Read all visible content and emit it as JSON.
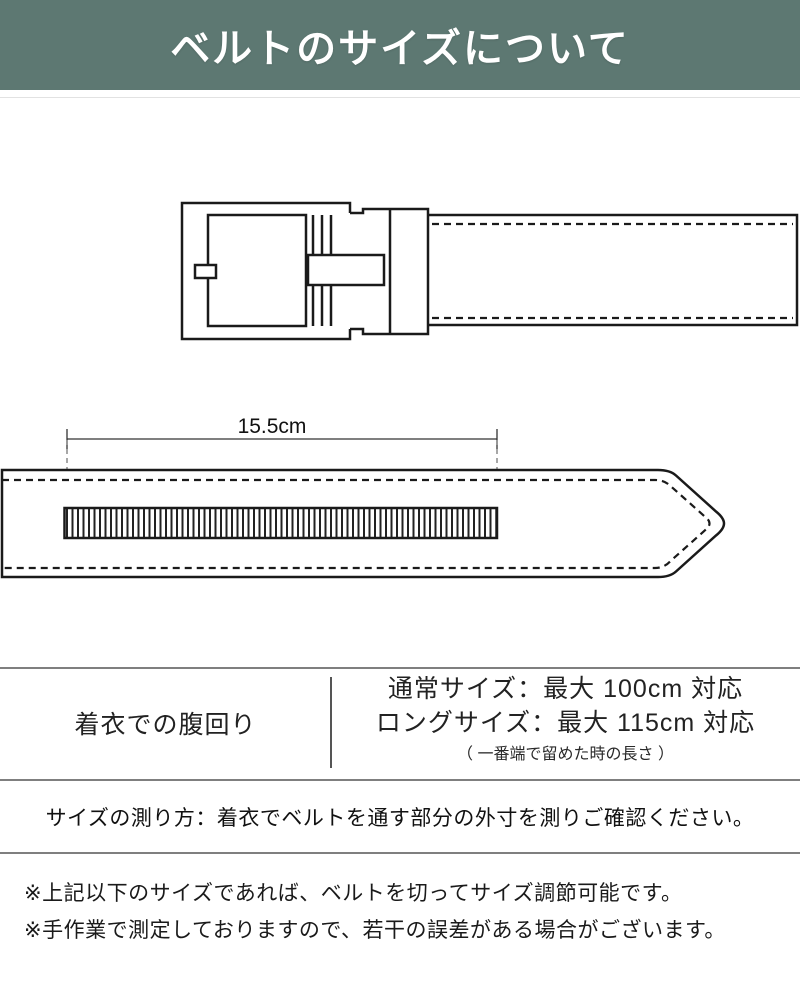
{
  "header": {
    "title": "ベルトのサイズについて",
    "bg_color": "#5d7872",
    "text_color": "#ffffff"
  },
  "diagram": {
    "dimension_label": "15.5cm",
    "line_color": "#1a1a1a"
  },
  "size_table": {
    "row_label": "着衣での腹回り",
    "sizes": [
      {
        "label": "通常サイズ：最大 100cm 対応"
      },
      {
        "label": "ロングサイズ：最大 115cm 対応"
      }
    ],
    "note": "（ 一番端で留めた時の長さ ）",
    "rule_color": "#7f7f7f"
  },
  "measure_instruction": "サイズの測り方：着衣でベルトを通す部分の外寸を測りご確認ください。",
  "footnotes": [
    "※上記以下のサイズであれば、ベルトを切ってサイズ調節可能です。",
    "※手作業で測定しておりますので、若干の誤差がある場合がございます。"
  ]
}
